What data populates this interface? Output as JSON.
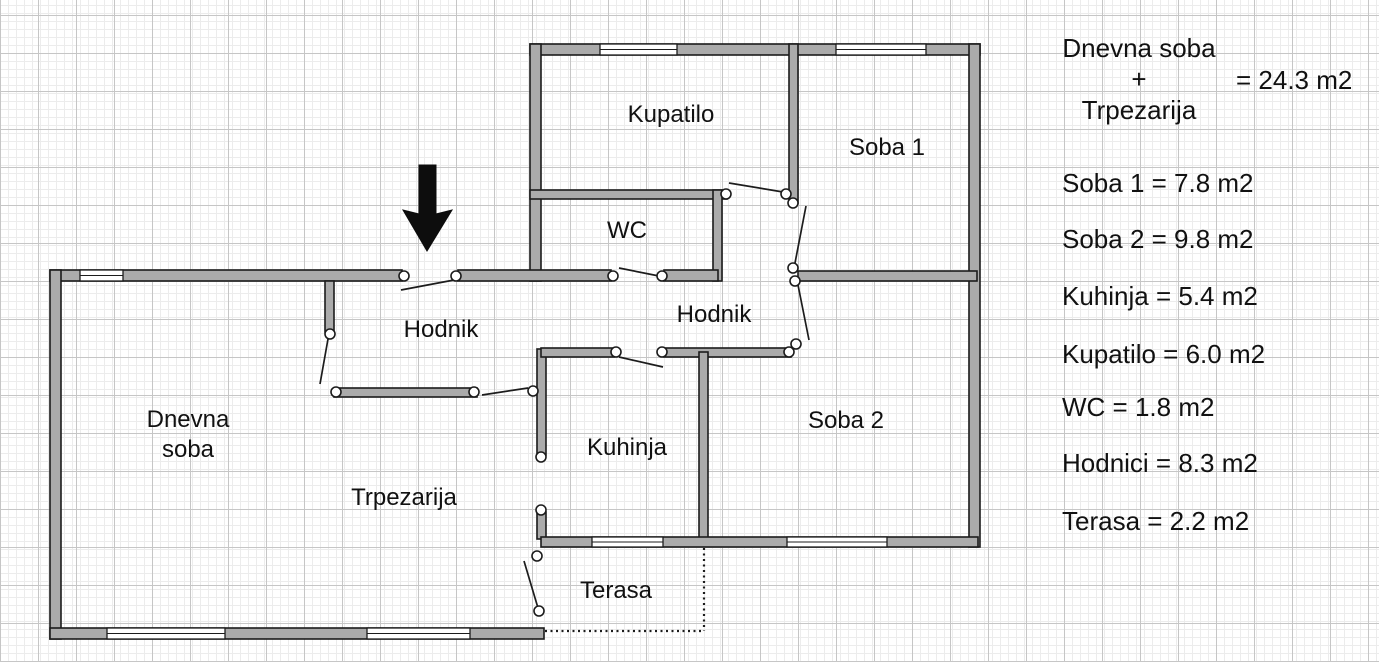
{
  "colors": {
    "wall_fill": "#ababab",
    "wall_stroke": "#1c1c1c",
    "grid_minor": "#ececec",
    "grid_major": "#c6c6c6",
    "bg": "#ffffff",
    "text": "#111111"
  },
  "plan": {
    "rooms": {
      "kupatilo": "Kupatilo",
      "soba1": "Soba 1",
      "wc": "WC",
      "hodnik_left": "Hodnik",
      "hodnik_right": "Hodnik",
      "dnevna_soba": "Dnevna soba",
      "kuhinja": "Kuhinja",
      "trpezarija": "Trpezarija",
      "soba2": "Soba 2",
      "terasa": "Terasa"
    }
  },
  "legend": {
    "combined": {
      "line1": "Dnevna soba",
      "line2": "+",
      "line3": "Trpezarija",
      "value": "= 24.3 m2"
    },
    "items": [
      {
        "text": "Soba 1 = 7.8 m2"
      },
      {
        "text": "Soba 2 = 9.8 m2"
      },
      {
        "text": "Kuhinja = 5.4 m2"
      },
      {
        "text": "Kupatilo = 6.0 m2"
      },
      {
        "text": "WC = 1.8 m2"
      },
      {
        "text": "Hodnici = 8.3 m2"
      },
      {
        "text": "Terasa = 2.2 m2"
      }
    ]
  }
}
